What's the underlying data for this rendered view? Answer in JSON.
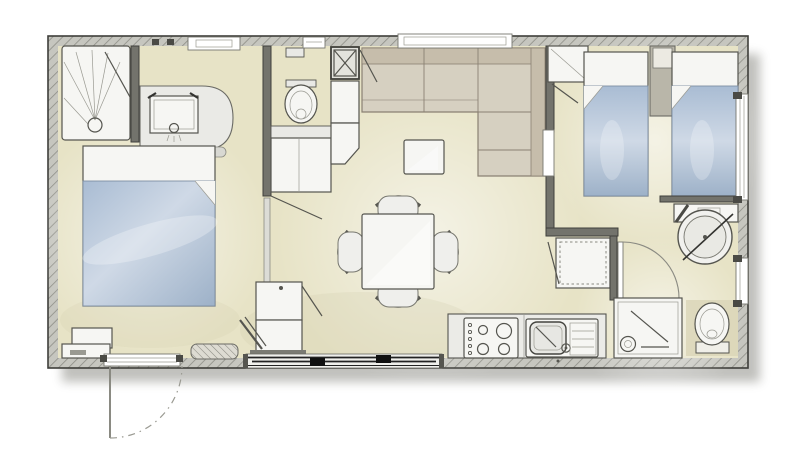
{
  "image": {
    "kind": "architectural-floor-plan",
    "subject": "mobile-home-2-bedroom-floor-plan",
    "text_labels": []
  },
  "palette": {
    "background": "#ffffff",
    "floor": "#e7e3c6",
    "floor_light": "#f3f0da",
    "floor_shade": "#cdc9a8",
    "wall_fill": "#c6c6bf",
    "wall_hatch": "#8e8e86",
    "wall_stroke": "#3e3e3a",
    "partition": "#73736c",
    "furniture": "#f6f6f3",
    "furniture_light": "#e9e9e5",
    "outline": "#55554f",
    "bed_blue": "#a9bcd3",
    "bed_blue_deep": "#9db1c8",
    "bed_blue_light": "#cfd9e6",
    "sofa_back": "#c6bdab",
    "sofa_seat": "#d6d0c1",
    "sofa_line": "#8a8173",
    "toilet_mat": "#d9d5b6",
    "glass_line": "#222222",
    "shadow": "#6b6b62"
  },
  "floorplan": {
    "rooms": [
      {
        "id": "master-bedroom",
        "fixtures": [
          "double-bed",
          "shower-cabin",
          "vanity-sink",
          "bedside-cabinets",
          "floor-vent",
          "entrance-door",
          "doorway-threshold"
        ]
      },
      {
        "id": "wc-room",
        "fixtures": [
          "toilet",
          "vanity-counter",
          "wall-niche",
          "window",
          "technical-shaft",
          "tall-cabinets"
        ]
      },
      {
        "id": "living-room",
        "fixtures": [
          "corner-sofa",
          "coffee-table",
          "dining-table",
          "chair",
          "chair",
          "chair",
          "chair",
          "storage-cabinets",
          "window",
          "sliding-glass-door"
        ]
      },
      {
        "id": "kitchen",
        "fixtures": [
          "worktop",
          "hob-four-burners",
          "sink-with-drainer",
          "refrigerator"
        ]
      },
      {
        "id": "twin-bedroom",
        "fixtures": [
          "single-bed",
          "single-bed",
          "wardrobe",
          "headboard-divider-with-niche",
          "door",
          "window"
        ]
      },
      {
        "id": "bathroom",
        "fixtures": [
          "round-washbasin",
          "basin-counter",
          "shower-tray",
          "toilet",
          "door",
          "window"
        ]
      }
    ],
    "exterior": [
      "hatched-outer-walls",
      "entrance-door-swing-outside",
      "drop-shadow-bottom-right"
    ]
  }
}
